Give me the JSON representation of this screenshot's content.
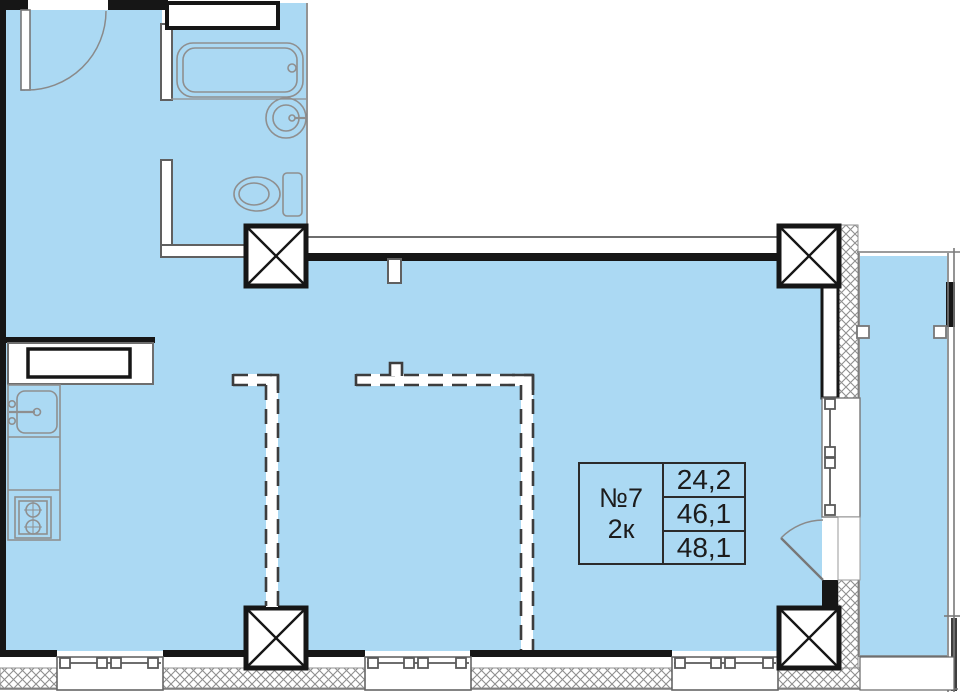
{
  "unit_card": {
    "number": "№7",
    "rooms": "2к",
    "areas": [
      "24,2",
      "46,1",
      "48,1"
    ]
  },
  "colors": {
    "room_fill": "#abd9f3",
    "wall_black": "#161616",
    "partition_dash": "#3d3d3d",
    "fixture_outline": "#8f8f8f",
    "background": "#ffffff"
  },
  "icons": {
    "column": "column-x-icon",
    "bathtub": "bathtub-icon",
    "washbasin": "washbasin-icon",
    "toilet": "toilet-icon",
    "kitchen_sink": "kitchen-sink-icon",
    "stove": "stove-icon",
    "window": "window-glyph",
    "door": "door-swing-icon"
  }
}
